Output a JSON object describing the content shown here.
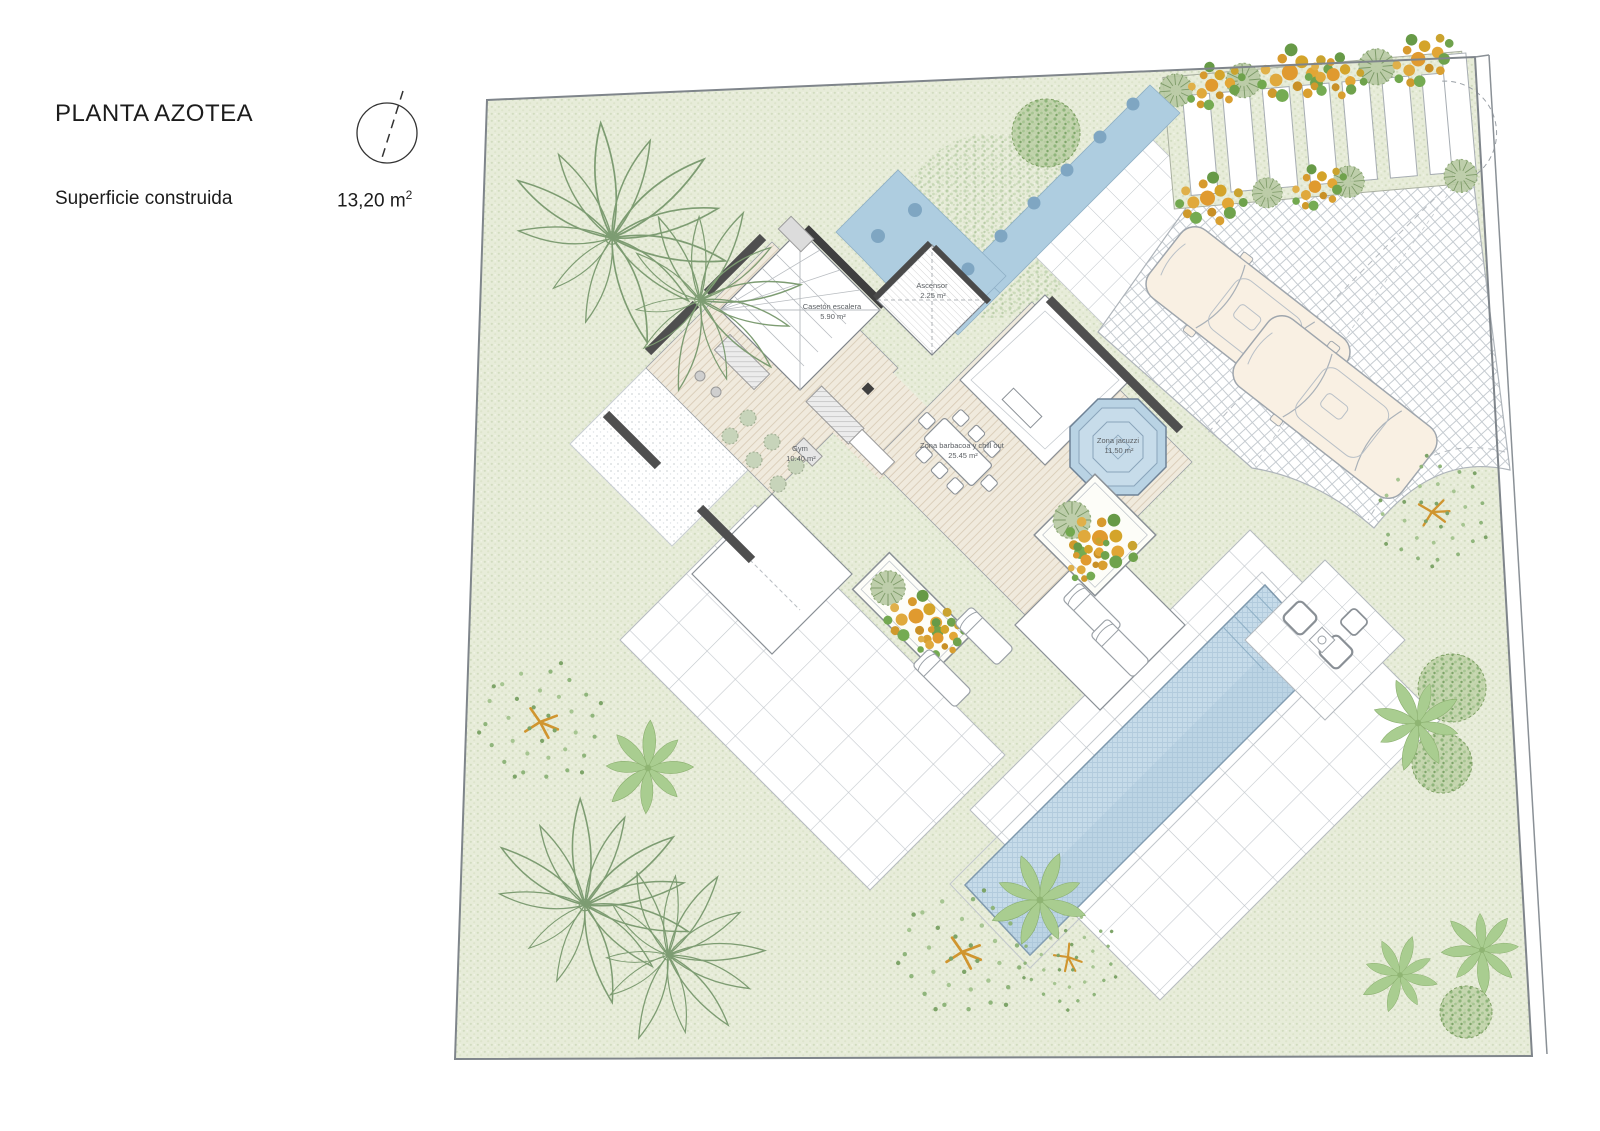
{
  "header": {
    "title": "PLANTA AZOTEA",
    "area_label": "Superficie construida",
    "area_value": "13,20 m",
    "area_sup": "2",
    "north_icon": "north-arrow"
  },
  "plan": {
    "rooms": [
      {
        "name": "Casetón escalera",
        "area": "5.90 m²"
      },
      {
        "name": "Ascensor",
        "area": "2.25 m²"
      },
      {
        "name": "Gym",
        "area": "10.40 m²"
      },
      {
        "name": "Zona barbacoa y chill out",
        "area": "25.45 m²"
      },
      {
        "name": "Zona jacuzzi",
        "area": "11.50 m²"
      }
    ],
    "colors": {
      "garden": "#e7ecd9",
      "water_channel": "#aecde0",
      "pool": "#c6dbe9",
      "flower_orange": "#df9c33",
      "foliage": "#7d9c72",
      "wall_dark": "#4f4f4f",
      "line_gray": "#8a9096"
    }
  }
}
